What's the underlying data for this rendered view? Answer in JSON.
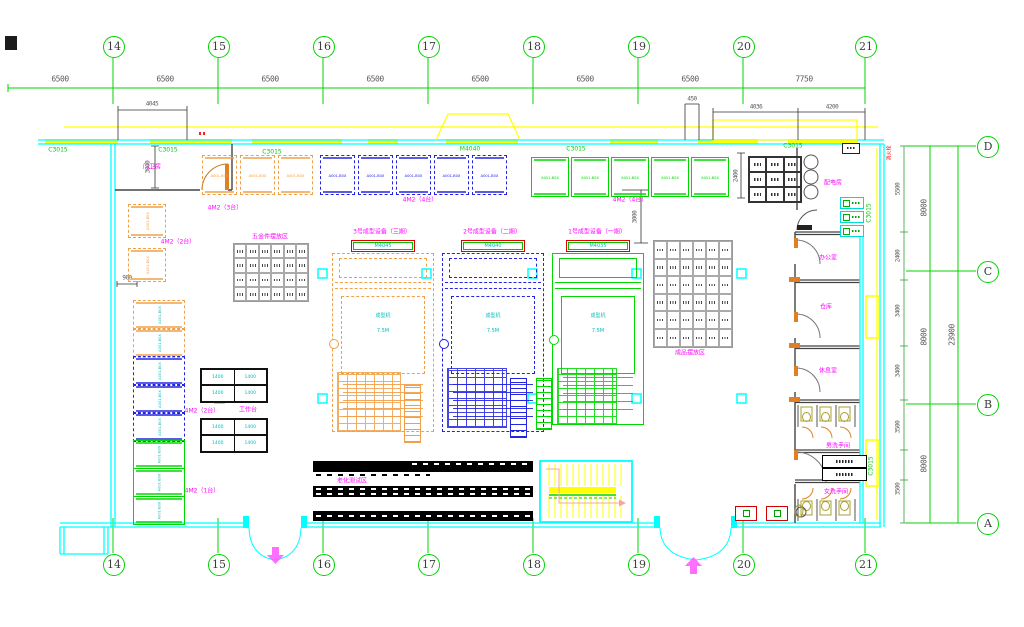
{
  "drawing": {
    "type": "factory floor plan (CAD)",
    "colors": {
      "grid_green": "#00d400",
      "wall_cyan": "#00ffff",
      "window_yellow": "#ffff00",
      "machine_orange": "#f0a048",
      "machine_blue": "#2424e0",
      "machine_green": "#00d800",
      "label_magenta": "#ff00ff",
      "label_cyan": "#00bdbd",
      "dim_text": "#5a5a5a",
      "alert_red": "#ff1010"
    }
  },
  "grid": {
    "cols": [
      {
        "label": "14",
        "x": 113
      },
      {
        "label": "15",
        "x": 218
      },
      {
        "label": "16",
        "x": 323
      },
      {
        "label": "17",
        "x": 428
      },
      {
        "label": "18",
        "x": 533
      },
      {
        "label": "19",
        "x": 638
      },
      {
        "label": "20",
        "x": 743
      },
      {
        "label": "21",
        "x": 865
      }
    ],
    "rows": [
      {
        "label": "D",
        "y": 146
      },
      {
        "label": "C",
        "y": 271
      },
      {
        "label": "B",
        "y": 404
      },
      {
        "label": "A",
        "y": 523
      }
    ],
    "top_dims": [
      {
        "text": "6500",
        "cx": 60
      },
      {
        "text": "6500",
        "cx": 165
      },
      {
        "text": "6500",
        "cx": 270
      },
      {
        "text": "6500",
        "cx": 375
      },
      {
        "text": "6500",
        "cx": 480
      },
      {
        "text": "6500",
        "cx": 585
      },
      {
        "text": "6500",
        "cx": 690
      },
      {
        "text": "7750",
        "cx": 804
      }
    ],
    "right_dims_inner": [
      {
        "text": "8000",
        "cy": 208
      },
      {
        "text": "8000",
        "cy": 337
      },
      {
        "text": "8000",
        "cy": 464
      }
    ],
    "right_dims_outer": [
      {
        "text": "23900",
        "cy": 335
      }
    ],
    "room_dims": [
      {
        "text": "5500",
        "cy": 189
      },
      {
        "text": "2400",
        "cy": 256
      },
      {
        "text": "3400",
        "cy": 311
      },
      {
        "text": "3400",
        "cy": 371
      },
      {
        "text": "3500",
        "cy": 427
      },
      {
        "text": "3500",
        "cy": 489
      }
    ],
    "sub_dims": [
      {
        "text": "4045",
        "cx": 152,
        "cy": 104,
        "rot": false
      },
      {
        "text": "450",
        "cx": 692,
        "cy": 99,
        "rot": false
      },
      {
        "text": "4036",
        "cx": 756,
        "cy": 107,
        "rot": false
      },
      {
        "text": "4200",
        "cx": 832,
        "cy": 107,
        "rot": false
      },
      {
        "text": "3000",
        "cx": 148,
        "cy": 167,
        "rot": true
      },
      {
        "text": "900",
        "cx": 127,
        "cy": 278,
        "rot": false
      },
      {
        "text": "3000",
        "cx": 635,
        "cy": 217,
        "rot": true
      },
      {
        "text": "2400",
        "cx": 736,
        "cy": 176,
        "rot": true
      }
    ]
  },
  "windows": {
    "labels": [
      {
        "text": "C3015",
        "cx": 58,
        "cy": 150,
        "rot": false
      },
      {
        "text": "C3015",
        "cx": 168,
        "cy": 150,
        "rot": false
      },
      {
        "text": "C3015",
        "cx": 272,
        "cy": 152,
        "rot": false
      },
      {
        "text": "M4040",
        "cx": 470,
        "cy": 149,
        "rot": false
      },
      {
        "text": "C3015",
        "cx": 576,
        "cy": 149,
        "rot": false
      },
      {
        "text": "C3015",
        "cx": 793,
        "cy": 146,
        "rot": false
      },
      {
        "text": "C3015",
        "cx": 869,
        "cy": 213,
        "rot": true
      },
      {
        "text": "C3015",
        "cx": 871,
        "cy": 466,
        "rot": true
      }
    ],
    "bands": [
      [
        45,
        118
      ],
      [
        150,
        232
      ],
      [
        252,
        342
      ],
      [
        368,
        398
      ],
      [
        446,
        518
      ],
      [
        610,
        658
      ],
      [
        698,
        758
      ],
      [
        788,
        858
      ]
    ]
  },
  "labels": {
    "magenta": [
      {
        "text": "门卫房",
        "cx": 152,
        "cy": 166
      },
      {
        "text": "4M2（3台）",
        "cx": 225,
        "cy": 207
      },
      {
        "text": "4M2（4台）",
        "cx": 420,
        "cy": 199
      },
      {
        "text": "4M2（4台）",
        "cx": 630,
        "cy": 199
      },
      {
        "text": "4M2（2台）",
        "cx": 178,
        "cy": 241
      },
      {
        "text": "4M2（2台）",
        "cx": 202,
        "cy": 410
      },
      {
        "text": "4M2（1台）",
        "cx": 202,
        "cy": 490
      },
      {
        "text": "五金件摆放区",
        "cx": 270,
        "cy": 236
      },
      {
        "text": "成品摆放区",
        "cx": 690,
        "cy": 352
      },
      {
        "text": "工作台",
        "cx": 248,
        "cy": 409
      },
      {
        "text": "老化测试区",
        "cx": 352,
        "cy": 480
      },
      {
        "text": "配电房",
        "cx": 833,
        "cy": 182
      },
      {
        "text": "办公室",
        "cx": 828,
        "cy": 257
      },
      {
        "text": "仓库",
        "cx": 826,
        "cy": 306
      },
      {
        "text": "休息室",
        "cx": 828,
        "cy": 370
      },
      {
        "text": "男洗手间",
        "cx": 838,
        "cy": 445
      },
      {
        "text": "女洗手间",
        "cx": 836,
        "cy": 491
      }
    ],
    "red": [
      {
        "text": "消火栓",
        "cx": 889,
        "cy": 153
      }
    ]
  },
  "machines_top": {
    "unit_text": "A001-B0X",
    "rows": [
      {
        "name": "press-row-orange",
        "color": "#f0a048",
        "dash": true,
        "x": 202,
        "y": 155,
        "w": 33,
        "h": 38,
        "step": 38,
        "count": 3
      },
      {
        "name": "press-row-blue",
        "color": "#2424e0",
        "dash": true,
        "x": 320,
        "y": 155,
        "w": 33,
        "h": 38,
        "step": 38,
        "count": 5
      },
      {
        "name": "press-row-green",
        "color": "#00d800",
        "dash": false,
        "x": 531,
        "y": 157,
        "w": 36,
        "h": 38,
        "step": 40,
        "count": 5
      }
    ]
  },
  "left_pair": {
    "cell_text": "A001-B0X",
    "x": 128,
    "ys": [
      204,
      248
    ],
    "w": 36,
    "h": 32,
    "color": "#f0a048"
  },
  "left_stack": {
    "cell_text": "A001-B0X",
    "x": 133,
    "w": 50,
    "groups": [
      {
        "color": "#f0a048",
        "dash": true,
        "ys": [
          300,
          328
        ],
        "h": 28
      },
      {
        "color": "#2424e0",
        "dash": true,
        "ys": [
          356,
          384,
          412
        ],
        "h": 28
      },
      {
        "color": "#00d800",
        "dash": false,
        "ys": [
          440,
          468,
          496
        ],
        "h": 27
      }
    ]
  },
  "racks": [
    {
      "name": "rack-left",
      "x": 233,
      "y": 243,
      "cols": 6,
      "rows": 4,
      "cw": 12.4,
      "ch": 14.3
    },
    {
      "name": "rack-right",
      "x": 653,
      "y": 240,
      "cols": 6,
      "rows": 6,
      "cw": 13,
      "ch": 17.6
    }
  ],
  "grid3x3": {
    "x": 748,
    "y": 156,
    "cols": 3,
    "rows": 3,
    "cw": 17.3,
    "ch": 15
  },
  "tables": {
    "cell_text": "1400",
    "w": 64,
    "rh": 15,
    "groups": [
      {
        "x": 200,
        "rows": [
          368,
          384
        ]
      },
      {
        "x": 200,
        "rows": [
          418,
          434
        ]
      }
    ]
  },
  "big_machines": [
    {
      "title": "3号成型设备（三期）",
      "header": "M4045",
      "line1": "成型机",
      "line2": "7.5M",
      "x": 332,
      "y": 253,
      "w": 100,
      "h": 177,
      "color": "#f0a048",
      "dash": true,
      "brick": [
        337,
        372,
        62,
        58
      ],
      "side": [
        404,
        385,
        15,
        56
      ]
    },
    {
      "title": "2号成型设备（二期）",
      "header": "M4040",
      "line1": "成型机",
      "line2": "7.5M",
      "x": 442,
      "y": 253,
      "w": 100,
      "h": 177,
      "color": "#2424e0",
      "dash": true,
      "brick": [
        447,
        368,
        58,
        58
      ],
      "side": [
        510,
        378,
        15,
        58
      ]
    },
    {
      "title": "1号成型设备（一期）",
      "header": "M4035",
      "line1": "成型机",
      "line2": "7.5M",
      "x": 552,
      "y": 253,
      "w": 90,
      "h": 170,
      "color": "#00d800",
      "dash": false,
      "brick": [
        557,
        368,
        58,
        55
      ],
      "side": [
        536,
        378,
        14,
        50
      ]
    }
  ],
  "conveyors": {
    "bars": [
      {
        "x": 313,
        "y": 461,
        "w": 220,
        "h": 11,
        "variant": "split"
      },
      {
        "x": 313,
        "y": 486,
        "w": 220,
        "h": 11,
        "variant": "double"
      },
      {
        "x": 313,
        "y": 511,
        "w": 220,
        "h": 10,
        "variant": "single"
      }
    ]
  },
  "columns": [
    [
      318,
      269
    ],
    [
      422,
      269
    ],
    [
      528,
      269
    ],
    [
      632,
      269
    ],
    [
      737,
      269
    ],
    [
      215,
      394
    ],
    [
      318,
      394
    ],
    [
      528,
      394
    ],
    [
      632,
      394
    ],
    [
      737,
      394
    ]
  ],
  "right_rooms": {
    "wall_ys": [
      232,
      280,
      346,
      400,
      450,
      480
    ]
  },
  "stairs": {
    "x": 540,
    "y": 461,
    "w": 92,
    "h": 61
  }
}
